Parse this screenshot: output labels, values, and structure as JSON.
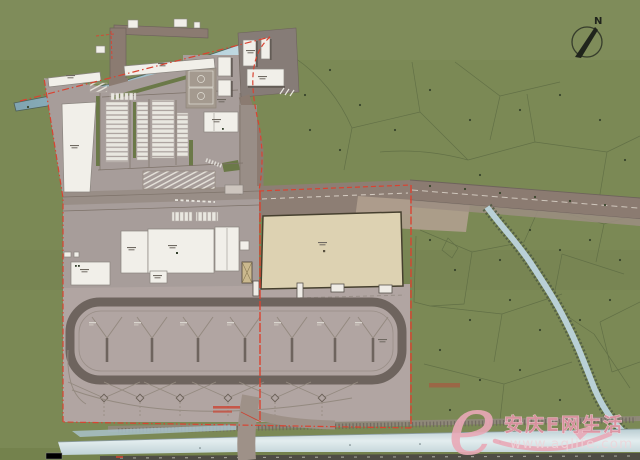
{
  "compass": {
    "label": "N"
  },
  "watermark": {
    "logo_letter": "e",
    "brand": "安庆E网生活",
    "url": "www.aqlife.com"
  },
  "palette": {
    "grass": "#7b8955",
    "pavement_north": "#a79d9a",
    "pavement_yard": "#b1a5a2",
    "road": "#8b7b71",
    "building_white": "#f1efe9",
    "terminal_beige": "#ddd2b2",
    "water_canal": "#9fc0cd",
    "water_river": "#cfdfe3",
    "boundary_red": "#d94331",
    "watermark_pink": "#e2a0ae"
  }
}
